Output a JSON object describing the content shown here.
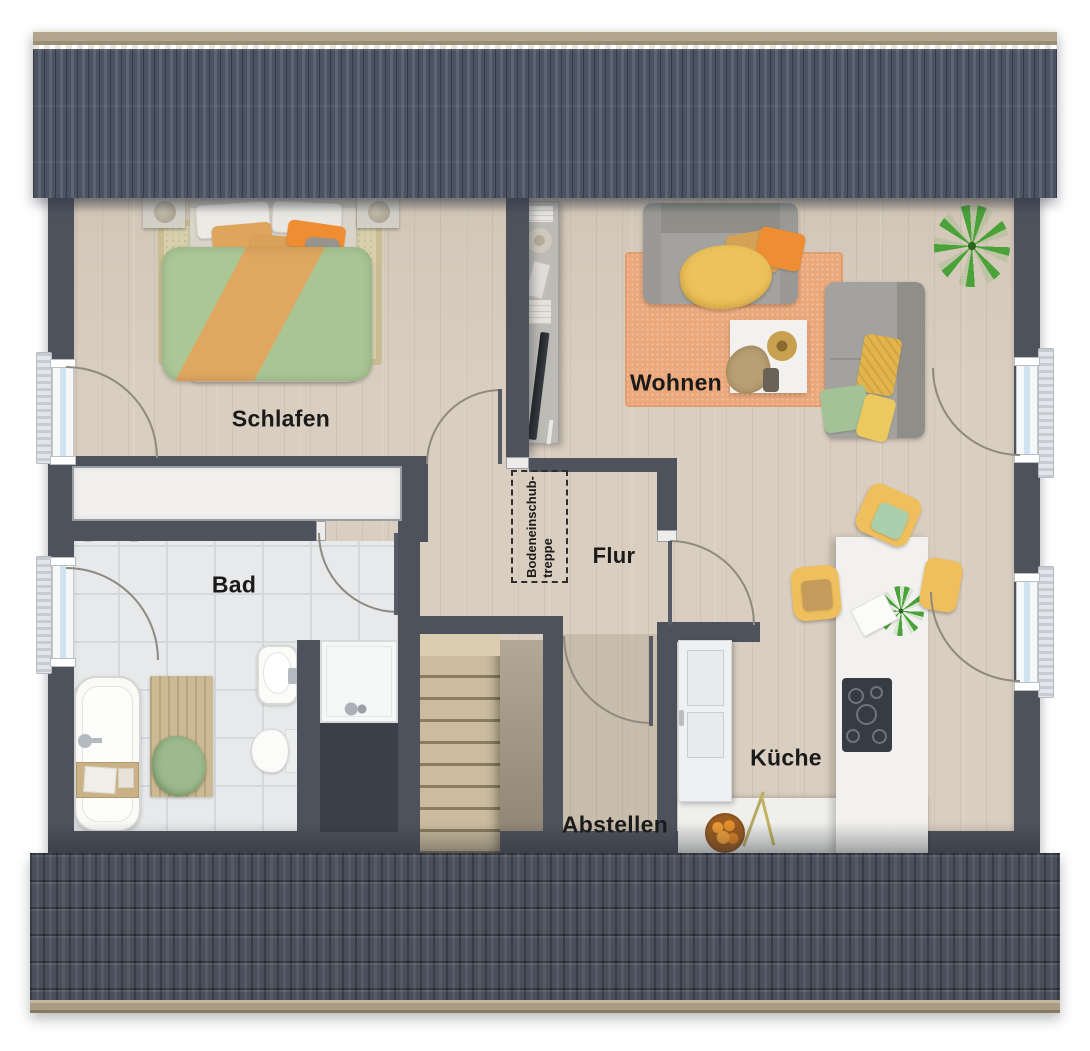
{
  "rooms": {
    "schlafen": {
      "label": "Schlafen"
    },
    "wohnen": {
      "label": "Wohnen"
    },
    "bad": {
      "label": "Bad"
    },
    "flur": {
      "label": "Flur"
    },
    "kueche": {
      "label": "Küche"
    },
    "abstellen": {
      "label": "Abstellen"
    },
    "attic_stairs": {
      "line1": "Bodeneinschub-",
      "line2": "treppe"
    }
  },
  "scene_inventory": {
    "schlafen": [
      "double-bed",
      "area-rug",
      "bedside-table-left",
      "bedside-table-right",
      "table-lamps"
    ],
    "wohnen": [
      "sofa",
      "chaise-sofa",
      "coffee-table",
      "decor-bowl",
      "pampas-vase",
      "media-sideboard",
      "tv",
      "books",
      "area-rug",
      "palm-plant"
    ],
    "bad": [
      "bathtub",
      "bath-caddy",
      "wooden-mat",
      "towel",
      "washbasin",
      "toilet",
      "shower",
      "towel-rail"
    ],
    "kueche": [
      "kitchen-island",
      "cooktop",
      "tall-cabinet",
      "counter",
      "bar-chair-top",
      "bar-chair-left",
      "bar-chair-right",
      "island-plant",
      "fruit-bowl",
      "flower-branch"
    ],
    "flur": [
      "attic-pull-down-stairs-hatch",
      "staircase"
    ],
    "fenster": [
      "window-left-schlafen",
      "window-left-bad",
      "window-right-wohnen",
      "window-right-kueche",
      "radiators"
    ]
  },
  "palette": {
    "wall": "#4d525d",
    "void": "#3a3f49",
    "wood": "#d9cec0",
    "tile": "#e7e9eb",
    "tile_line": "#d6d9dc",
    "roof_top": "#4b5362",
    "roof_bottom": "#49505c",
    "ridge": "#b3a58e",
    "gutter": "#aa9c85",
    "glass": "#cfe2f0",
    "frame": "#f5f7f9",
    "radiator": "#e2e6ea",
    "arc": "#8f8a80",
    "leaf": "#565b66",
    "label": "#1a1a1a",
    "rug_bed": "#d8cfae",
    "rug_living": "#eba87a",
    "sofa": "#a3a29e",
    "sofa_dark": "#8f8e89",
    "duvet_green": "#abc795",
    "duvet_orange": "#dfa75f",
    "pillow_orange": "#ef8d33",
    "throw_yellow": "#ecc25c",
    "chair_yellow": "#efbf5e",
    "cushion_green": "#a9cfad",
    "cushion_caramel": "#c59b5c",
    "plant": "#49a338",
    "white_furn": "#f2f1ef",
    "stairs": "#cbbc9e",
    "stairs_line": "#8a7c5e",
    "mat_wood": "#cdb993",
    "towel_green": "#9cba8c",
    "cooktop": "#363b44",
    "fridge": "#eef0f1",
    "closet": "#f1f0ee"
  }
}
